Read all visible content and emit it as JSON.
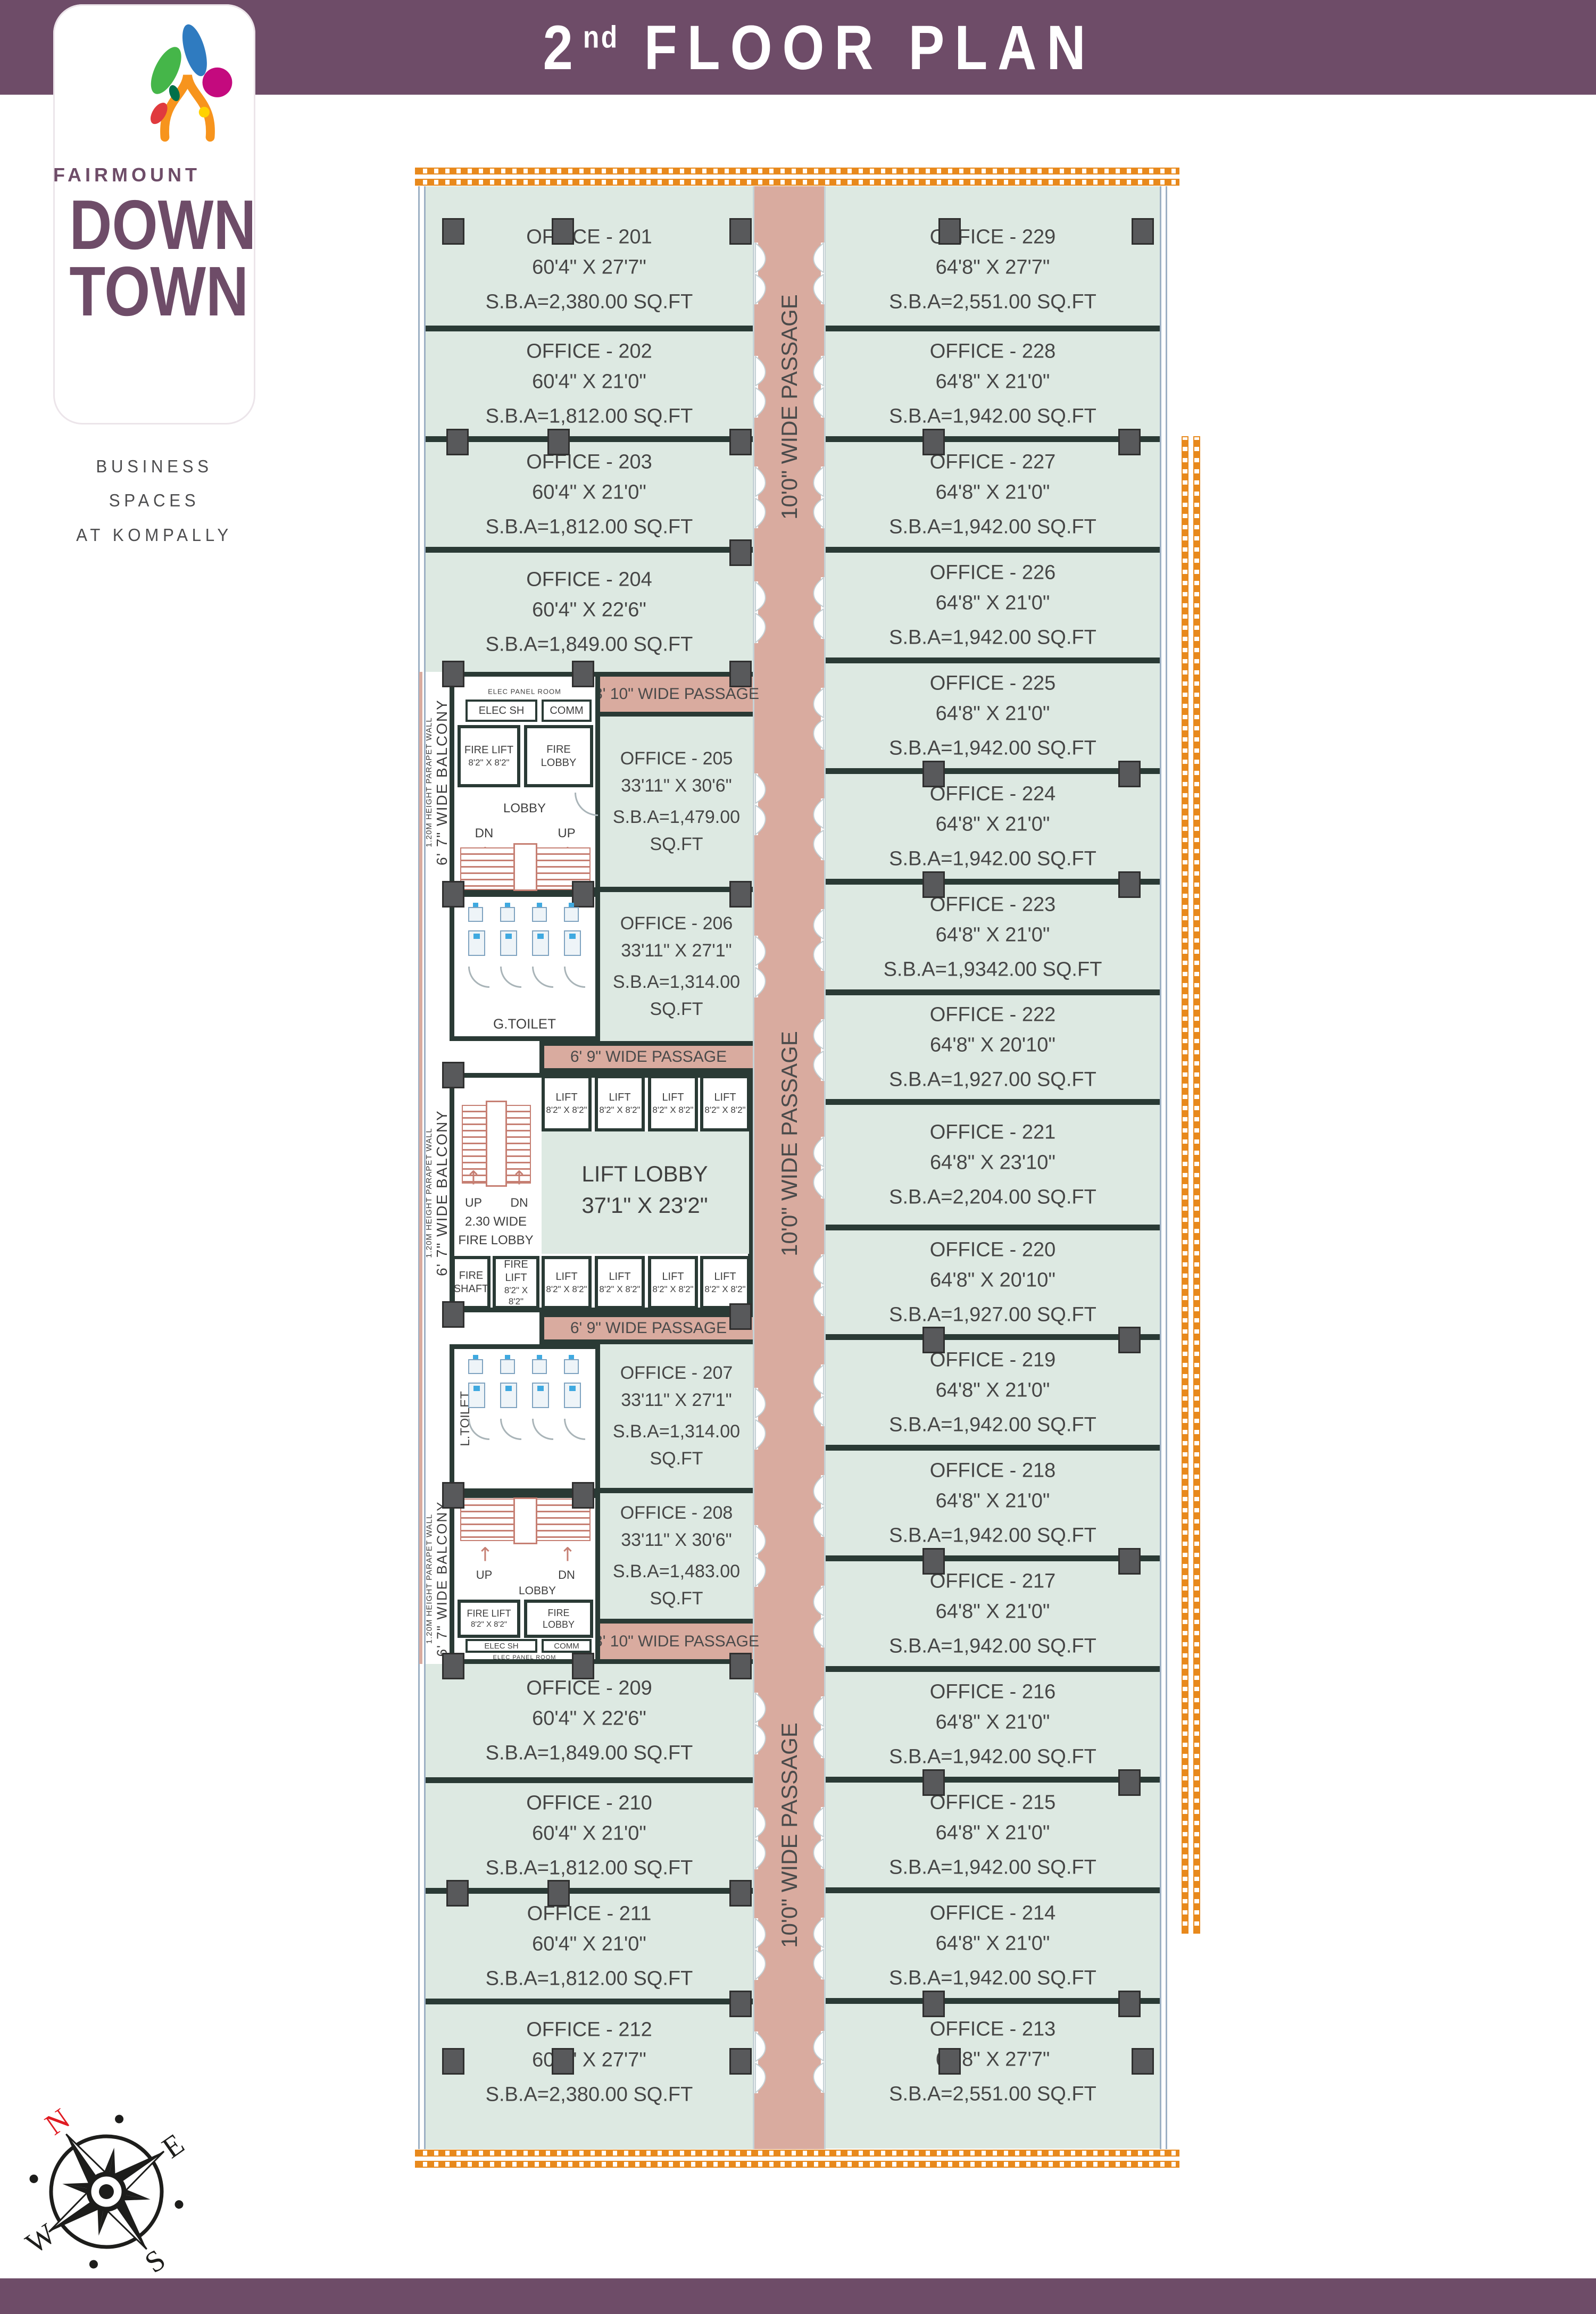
{
  "header": {
    "floor_number": "2",
    "floor_suffix": "nd",
    "title_rest": "FLOOR PLAN"
  },
  "logo": {
    "brand": "FAIRMOUNT",
    "line1": "DOWN",
    "line2": "TOWN",
    "tagline_line1": "BUSINESS SPACES",
    "tagline_line2": "AT KOMPALLY"
  },
  "colors": {
    "brand_purple": "#6e4c68",
    "passage_salmon": "#d9ab9f",
    "office_green": "#dde9e2",
    "wall_dark": "#2a3a35",
    "hatch_orange": "#e8891c",
    "stair_salmon": "#c67f73",
    "north_red": "#e01b22"
  },
  "plan": {
    "left_offices_top": [
      {
        "id": "201",
        "name": "OFFICE - 201",
        "dims": "60'4\" X 27'7\"",
        "sba": "S.B.A=2,380.00 SQ.FT"
      },
      {
        "id": "202",
        "name": "OFFICE - 202",
        "dims": "60'4\" X 21'0\"",
        "sba": "S.B.A=1,812.00 SQ.FT"
      },
      {
        "id": "203",
        "name": "OFFICE - 203",
        "dims": "60'4\" X 21'0\"",
        "sba": "S.B.A=1,812.00 SQ.FT"
      },
      {
        "id": "204",
        "name": "OFFICE - 204",
        "dims": "60'4\" X 22'6\"",
        "sba": "S.B.A=1,849.00 SQ.FT"
      }
    ],
    "mid_offices": [
      {
        "id": "205",
        "name": "OFFICE - 205",
        "dims": "33'11\" X 30'6\"",
        "sba": "S.B.A=1,479.00 SQ.FT"
      },
      {
        "id": "206",
        "name": "OFFICE - 206",
        "dims": "33'11\" X 27'1\"",
        "sba": "S.B.A=1,314.00 SQ.FT"
      },
      {
        "id": "207",
        "name": "OFFICE - 207",
        "dims": "33'11\" X 27'1\"",
        "sba": "S.B.A=1,314.00 SQ.FT"
      },
      {
        "id": "208",
        "name": "OFFICE - 208",
        "dims": "33'11\" X 30'6\"",
        "sba": "S.B.A=1,483.00 SQ.FT"
      }
    ],
    "left_offices_bottom": [
      {
        "id": "209",
        "name": "OFFICE - 209",
        "dims": "60'4\" X 22'6\"",
        "sba": "S.B.A=1,849.00 SQ.FT"
      },
      {
        "id": "210",
        "name": "OFFICE - 210",
        "dims": "60'4\" X 21'0\"",
        "sba": "S.B.A=1,812.00 SQ.FT"
      },
      {
        "id": "211",
        "name": "OFFICE - 211",
        "dims": "60'4\" X 21'0\"",
        "sba": "S.B.A=1,812.00 SQ.FT"
      },
      {
        "id": "212",
        "name": "OFFICE - 212",
        "dims": "60'4\" X 27'7\"",
        "sba": "S.B.A=2,380.00 SQ.FT"
      }
    ],
    "right_offices": [
      {
        "id": "229",
        "name": "OFFICE - 229",
        "dims": "64'8\" X 27'7\"",
        "sba": "S.B.A=2,551.00 SQ.FT"
      },
      {
        "id": "228",
        "name": "OFFICE - 228",
        "dims": "64'8\" X 21'0\"",
        "sba": "S.B.A=1,942.00 SQ.FT"
      },
      {
        "id": "227",
        "name": "OFFICE - 227",
        "dims": "64'8\" X 21'0\"",
        "sba": "S.B.A=1,942.00 SQ.FT"
      },
      {
        "id": "226",
        "name": "OFFICE - 226",
        "dims": "64'8\" X 21'0\"",
        "sba": "S.B.A=1,942.00 SQ.FT"
      },
      {
        "id": "225",
        "name": "OFFICE - 225",
        "dims": "64'8\" X 21'0\"",
        "sba": "S.B.A=1,942.00 SQ.FT"
      },
      {
        "id": "224",
        "name": "OFFICE - 224",
        "dims": "64'8\" X 21'0\"",
        "sba": "S.B.A=1,942.00 SQ.FT"
      },
      {
        "id": "223",
        "name": "OFFICE - 223",
        "dims": "64'8\" X 21'0\"",
        "sba": "S.B.A=1,9342.00 SQ.FT"
      },
      {
        "id": "222",
        "name": "OFFICE - 222",
        "dims": "64'8\" X 20'10\"",
        "sba": "S.B.A=1,927.00 SQ.FT"
      },
      {
        "id": "221",
        "name": "OFFICE - 221",
        "dims": "64'8\" X 23'10\"",
        "sba": "S.B.A=2,204.00 SQ.FT"
      },
      {
        "id": "220",
        "name": "OFFICE - 220",
        "dims": "64'8\" X 20'10\"",
        "sba": "S.B.A=1,927.00 SQ.FT"
      },
      {
        "id": "219",
        "name": "OFFICE - 219",
        "dims": "64'8\" X 21'0\"",
        "sba": "S.B.A=1,942.00 SQ.FT"
      },
      {
        "id": "218",
        "name": "OFFICE - 218",
        "dims": "64'8\" X 21'0\"",
        "sba": "S.B.A=1,942.00 SQ.FT"
      },
      {
        "id": "217",
        "name": "OFFICE - 217",
        "dims": "64'8\" X 21'0\"",
        "sba": "S.B.A=1,942.00 SQ.FT"
      },
      {
        "id": "216",
        "name": "OFFICE - 216",
        "dims": "64'8\" X 21'0\"",
        "sba": "S.B.A=1,942.00 SQ.FT"
      },
      {
        "id": "215",
        "name": "OFFICE - 215",
        "dims": "64'8\" X 21'0\"",
        "sba": "S.B.A=1,942.00 SQ.FT"
      },
      {
        "id": "214",
        "name": "OFFICE - 214",
        "dims": "64'8\" X 21'0\"",
        "sba": "S.B.A=1,942.00 SQ.FT"
      },
      {
        "id": "213",
        "name": "OFFICE - 213",
        "dims": "64'8\" X 27'7\"",
        "sba": "S.B.A=2,551.00 SQ.FT"
      }
    ],
    "passages": {
      "central": "10'0\" WIDE PASSAGE",
      "p810": "8' 10\" WIDE PASSAGE",
      "p69": "6' 9\" WIDE PASSAGE"
    },
    "balcony": {
      "width_label": "6' 7\" WIDE BALCONY",
      "parapet_label": "1.20M HEIGHT PARAPET WALL"
    },
    "service": {
      "elec_panel_room": "ELEC PANEL ROOM",
      "elec_sh": "ELEC SH",
      "comm": "COMM",
      "fire_lift": "FIRE LIFT",
      "lift": "LIFT",
      "lift_size": "8'2\" X 8'2\"",
      "fire_l1": "FIRE",
      "lobby_word": "LOBBY",
      "fire_lobby": "FIRE LOBBY",
      "shaft_word": "SHAFT",
      "lobby": "LOBBY",
      "dn": "DN",
      "up": "UP",
      "g_toilet": "G.TOILET",
      "l_toilet": "L.TOILET",
      "lift_lobby_name": "LIFT LOBBY",
      "lift_lobby_dims": "37'1\" X 23'2\"",
      "fire_lobby_230_l1": "2.30 WIDE",
      "fire_lobby_230_l2": "FIRE LOBBY"
    }
  },
  "compass": {
    "n": "N",
    "e": "E",
    "s": "S",
    "w": "W"
  }
}
